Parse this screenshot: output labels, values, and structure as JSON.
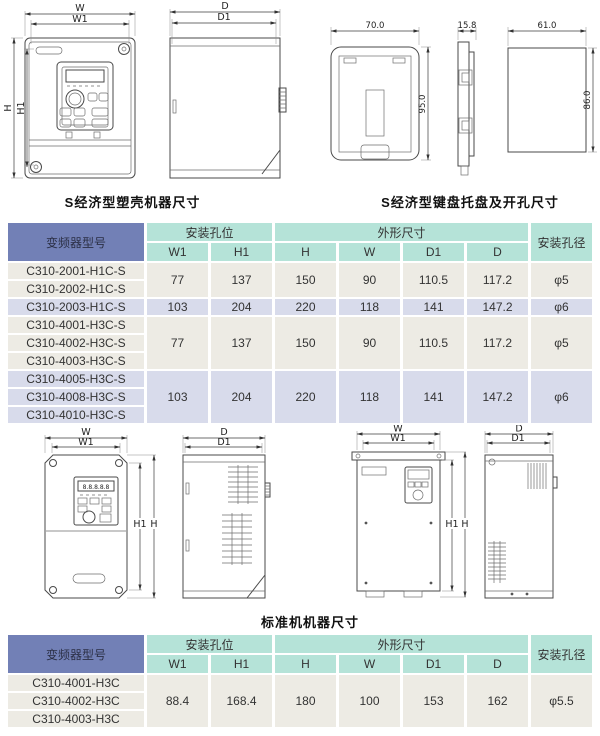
{
  "captions": {
    "top_left": "S经济型塑壳机器尺寸",
    "top_right": "S经济型键盘托盘及开孔尺寸",
    "middle": "标准机机器尺寸"
  },
  "dims": {
    "W": "W",
    "W1": "W1",
    "H": "H",
    "H1": "H1",
    "D": "D",
    "D1": "D1"
  },
  "tray": {
    "width": "70.0",
    "height": "95.0",
    "depth": "15.8",
    "hole_width": "61.0",
    "hole_height": "86.0"
  },
  "keypad_display": "8.8.8.8.8",
  "colors": {
    "header_blue": "#7280b6",
    "header_teal": "#b5e3d8",
    "row_beige": "#edebe4",
    "row_lavender": "#d8dbeb"
  },
  "table1": {
    "headers": {
      "model": "变频器型号",
      "mount": "安装孔位",
      "outline": "外形尺寸",
      "hole": "安装孔径",
      "cols": [
        "W1",
        "H1",
        "H",
        "W",
        "D1",
        "D"
      ]
    },
    "groups": [
      {
        "models": [
          "C310-2001-H1C-S",
          "C310-2002-H1C-S"
        ],
        "values": [
          "77",
          "137",
          "150",
          "90",
          "110.5",
          "117.2",
          "φ5"
        ]
      },
      {
        "models": [
          "C310-2003-H1C-S"
        ],
        "values": [
          "103",
          "204",
          "220",
          "118",
          "141",
          "147.2",
          "φ6"
        ]
      },
      {
        "models": [
          "C310-4001-H3C-S",
          "C310-4002-H3C-S",
          "C310-4003-H3C-S"
        ],
        "values": [
          "77",
          "137",
          "150",
          "90",
          "110.5",
          "117.2",
          "φ5"
        ]
      },
      {
        "models": [
          "C310-4005-H3C-S",
          "C310-4008-H3C-S",
          "C310-4010-H3C-S"
        ],
        "values": [
          "103",
          "204",
          "220",
          "118",
          "141",
          "147.2",
          "φ6"
        ]
      }
    ]
  },
  "table2": {
    "headers": {
      "model": "变频器型号",
      "mount": "安装孔位",
      "outline": "外形尺寸",
      "hole": "安装孔径",
      "cols": [
        "W1",
        "H1",
        "H",
        "W",
        "D1",
        "D"
      ]
    },
    "groups": [
      {
        "models": [
          "C310-4001-H3C",
          "C310-4002-H3C",
          "C310-4003-H3C"
        ],
        "values": [
          "88.4",
          "168.4",
          "180",
          "100",
          "153",
          "162",
          "φ5.5"
        ]
      }
    ]
  }
}
